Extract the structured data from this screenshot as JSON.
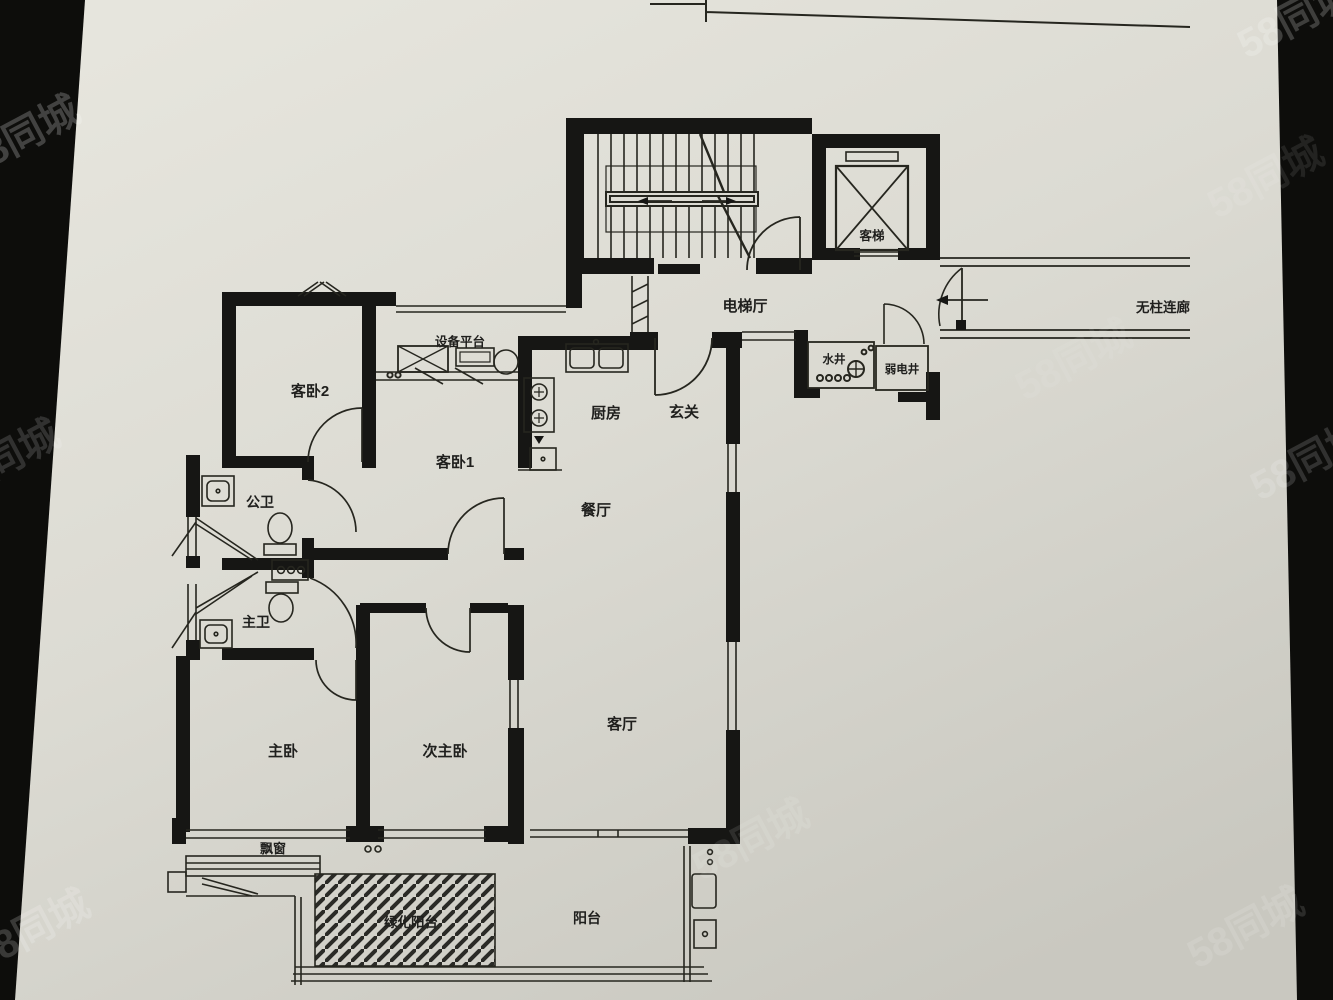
{
  "meta": {
    "description_colors": {
      "photo_background": "#0d0d0b",
      "paper_light": "#e2e1d9",
      "paper_dark": "#c9c8c0",
      "ink": "#1c1c1a",
      "watermark": "#ffffff"
    }
  },
  "watermark": {
    "text": "58同城"
  },
  "floor_plan": {
    "rooms": {
      "guest_bedroom_2": {
        "label": "客卧2"
      },
      "guest_bedroom_1": {
        "label": "客卧1"
      },
      "kitchen": {
        "label": "厨房"
      },
      "entry_hall": {
        "label": "玄关"
      },
      "dining_room": {
        "label": "餐厅"
      },
      "living_room": {
        "label": "客厅"
      },
      "master_bedroom": {
        "label": "主卧"
      },
      "second_master_bedroom": {
        "label": "次主卧"
      },
      "public_bathroom": {
        "label": "公卫"
      },
      "master_bathroom": {
        "label": "主卫"
      },
      "bay_window": {
        "label": "飘窗"
      },
      "green_balcony": {
        "label": "绿化阳台"
      },
      "balcony": {
        "label": "阳台"
      },
      "equipment_platform": {
        "label": "设备平台"
      },
      "elevator_hall": {
        "label": "电梯厅"
      },
      "passenger_elevator": {
        "label": "客梯"
      },
      "water_shaft": {
        "label": "水井"
      },
      "weak_current_shaft": {
        "label": "弱电井"
      },
      "covered_corridor": {
        "label": "无柱连廊"
      }
    }
  }
}
